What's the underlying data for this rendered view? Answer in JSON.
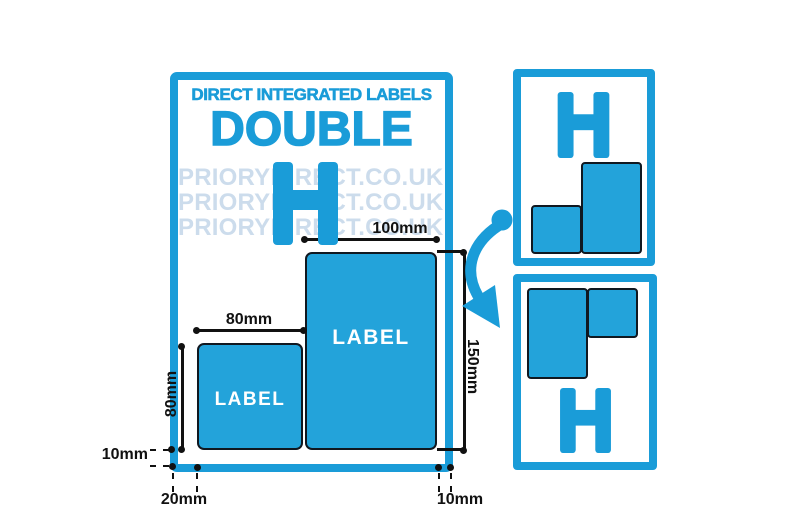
{
  "header": {
    "kicker": "DIRECT INTEGRATED LABELS",
    "title": "DOUBLE",
    "variant_letter": "H"
  },
  "watermark": {
    "text": "PRIORYDIRECT.CO.UK",
    "row_count": 3
  },
  "diagram": {
    "label_text": "LABEL",
    "dimensions": {
      "large_label_width": "100mm",
      "small_label_width": "80mm",
      "small_label_height": "80mm",
      "large_label_height": "150mm",
      "bottom_margin": "10mm",
      "left_offset": "20mm",
      "right_margin": "10mm"
    }
  },
  "colors": {
    "brand_blue": "#1a9cd8",
    "label_fill_blue": "#23a3da",
    "watermark_blue": "#ccdcec",
    "outline_dark": "#101820",
    "dimension_black": "#111111",
    "label_text_white": "#ffffff"
  }
}
